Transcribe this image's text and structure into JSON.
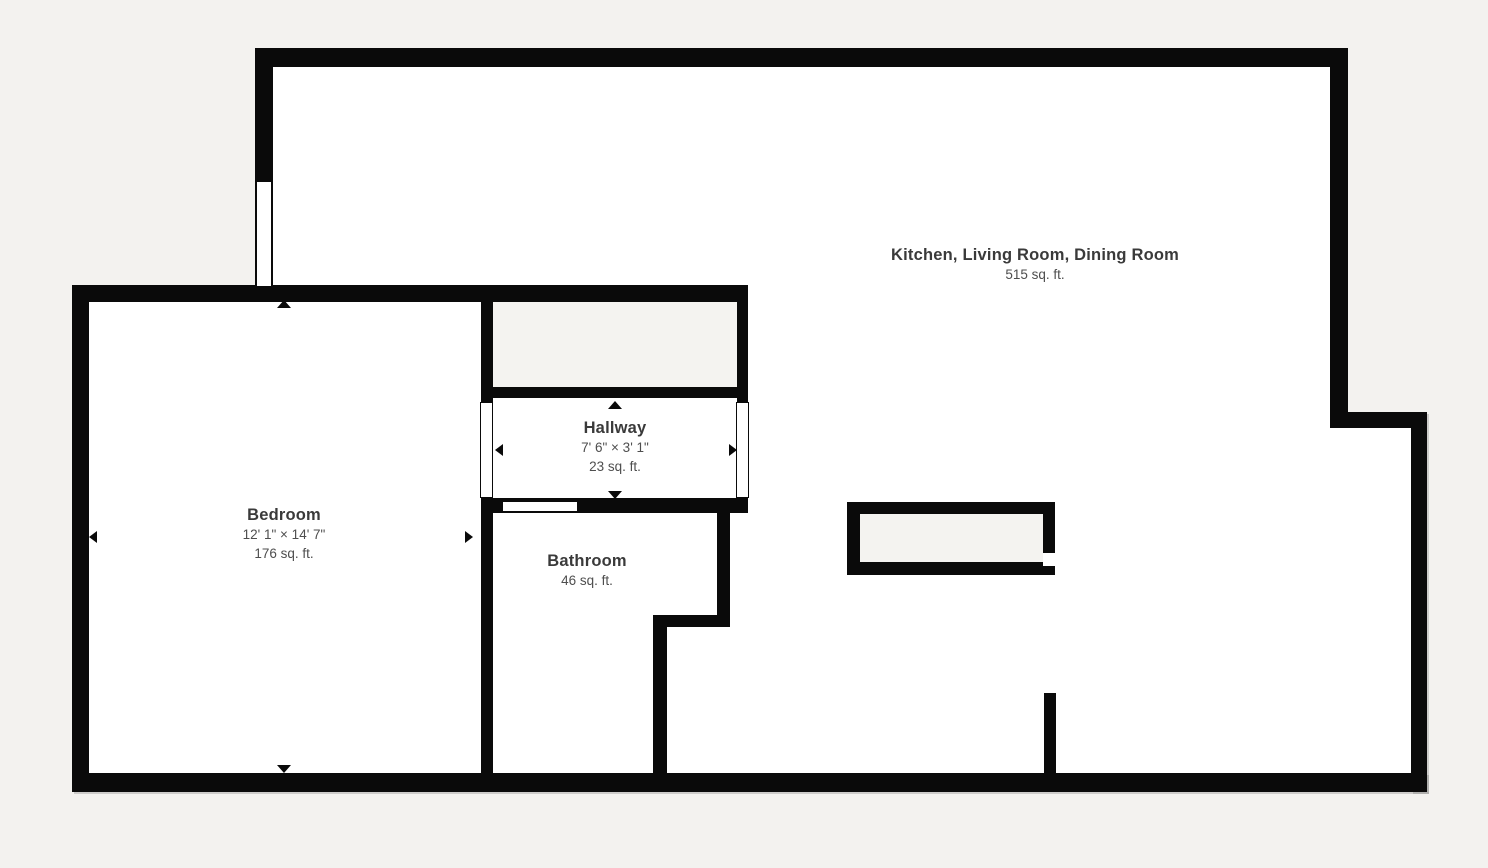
{
  "palette": {
    "background": "#f3f2ef",
    "wall": "#0a0a0a",
    "room_fill": "#ffffff",
    "closet_fill": "#f4f3f0",
    "title_text": "#3a3a3a",
    "subtitle_text": "#4e4e4e"
  },
  "plan": {
    "type": "floor-plan",
    "rooms": {
      "kitchen_living_dining": {
        "name": "Kitchen, Living Room, Dining Room",
        "area": "515 sq. ft."
      },
      "bedroom": {
        "name": "Bedroom",
        "dimensions": "12' 1\" × 14' 7\"",
        "area": "176 sq. ft."
      },
      "hallway": {
        "name": "Hallway",
        "dimensions": "7' 6\" × 3' 1\"",
        "area": "23 sq. ft."
      },
      "bathroom": {
        "name": "Bathroom",
        "area": "46 sq. ft."
      }
    },
    "icons": {
      "direction_markers": [
        "arrow-up-icon",
        "arrow-down-icon",
        "arrow-left-icon",
        "arrow-right-icon"
      ],
      "features": [
        "window",
        "door-opening",
        "kitchen-island",
        "closet",
        "partial-wall"
      ]
    }
  }
}
